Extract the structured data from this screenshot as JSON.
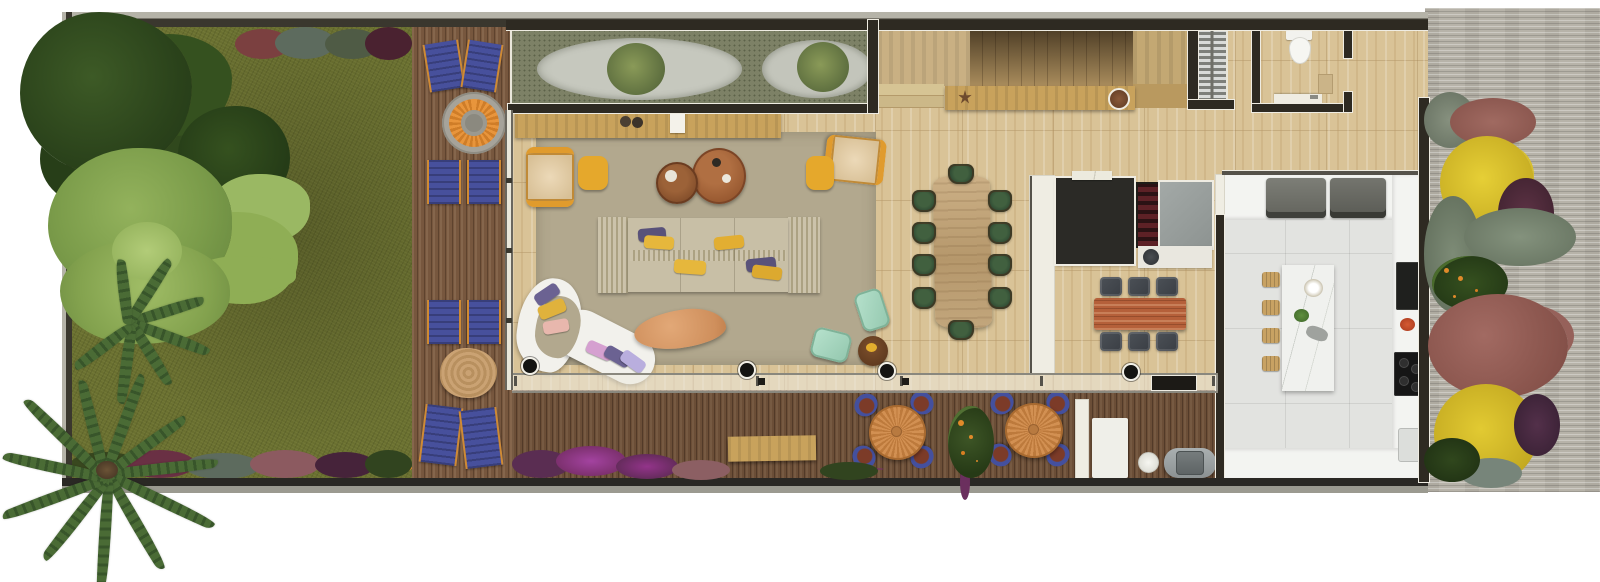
{
  "scene": {
    "kind": "architectural-floor-plan-rendering",
    "view": "top-down",
    "visible_text": "none",
    "areas": [
      "side-garden",
      "wood-deck",
      "zen-gravel-garden",
      "living-room",
      "dining-room",
      "staircase",
      "powder-room",
      "coffee-wine-bar",
      "kitchen",
      "outdoor-dining-deck",
      "service-area",
      "gravel-path-garden"
    ]
  },
  "palette": {
    "background": "#ffffff",
    "grass": "#6a7030",
    "deck_wood": "#77573e",
    "travertine_floor": "#d9c397",
    "rug": "#b2a88e",
    "kitchen_floor": "#e2e3e0",
    "gravel_path": "#b7b3a9",
    "wall_dark": "#2e2a22",
    "accent_yellow": "#e5a82c",
    "accent_navy": "#47509c",
    "accent_mint": "#a7d7c0",
    "accent_green_chair": "#2a4430",
    "wood_oak": "#c8a25c",
    "fire_pit_orange": "#e8953c",
    "flower_magenta": "#8c3a85",
    "bush_yellow": "#d8c22e"
  },
  "inventory": {
    "deck_lounge_chairs": 8,
    "fire_pit": 1,
    "stump_table": 1,
    "zen_gravel_mounds": 2,
    "living_armchairs": 2,
    "ottomans": 2,
    "round_coffee_tables": 2,
    "modular_sofa": 1,
    "sofa_pillows": 7,
    "curved_chaise": 1,
    "chaise_pillows": 6,
    "organic_coffee_table": 1,
    "mint_chairs": 2,
    "dining_chairs": 10,
    "dining_table": 1,
    "breakfast_table": 1,
    "bar_stools": 6,
    "kitchen_island": 1,
    "island_stools": 4,
    "built_in_appliances": 2,
    "cooktops": 2,
    "toilet": 1,
    "vanity": 1,
    "outdoor_round_tables": 2,
    "outdoor_chairs": 8,
    "garden_bench": 1,
    "bbq_grill": 1,
    "floor_spotlights": 4,
    "palm_trees": 2
  }
}
